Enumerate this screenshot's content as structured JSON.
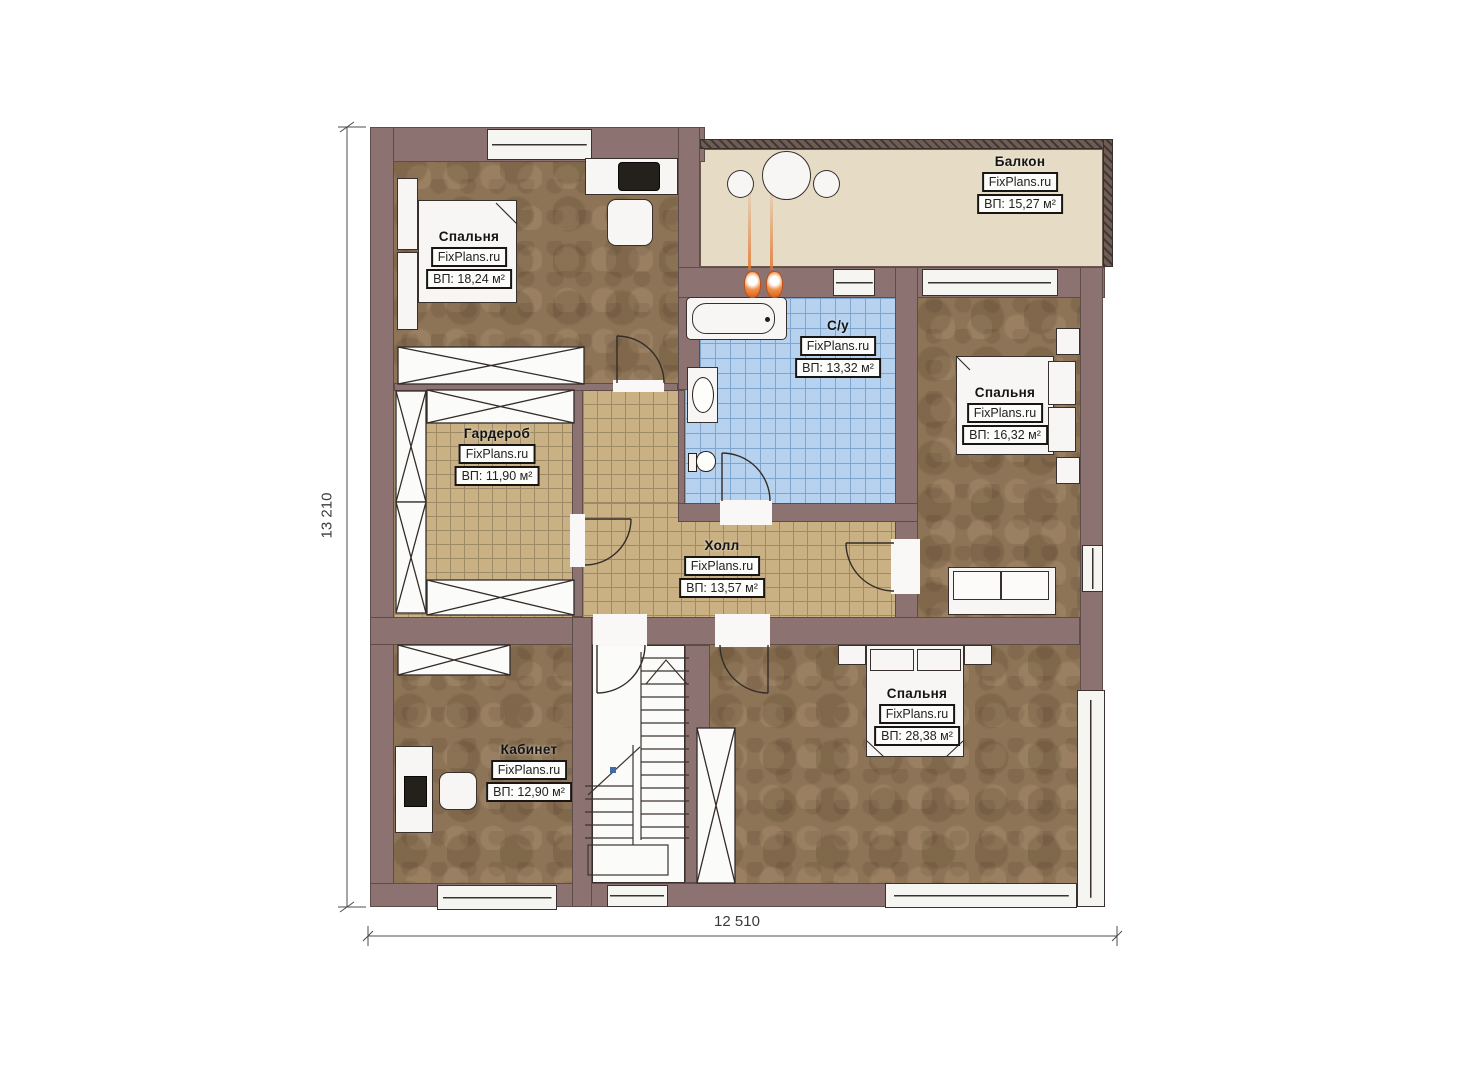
{
  "plan": {
    "type": "floor-plan",
    "watermark": "FixPlans.ru",
    "dimensions": {
      "height_label": "13 210",
      "width_label": "12 510"
    },
    "rooms": [
      {
        "key": "bedroom-top-left",
        "name": "Спальня",
        "brand": "FixPlans.ru",
        "area": "ВП: 18,24 м²"
      },
      {
        "key": "balcony",
        "name": "Балкон",
        "brand": "FixPlans.ru",
        "area": "ВП: 15,27 м²"
      },
      {
        "key": "bathroom",
        "name": "С/у",
        "brand": "FixPlans.ru",
        "area": "ВП: 13,32 м²"
      },
      {
        "key": "bedroom-right",
        "name": "Спальня",
        "brand": "FixPlans.ru",
        "area": "ВП: 16,32 м²"
      },
      {
        "key": "wardrobe",
        "name": "Гардероб",
        "brand": "FixPlans.ru",
        "area": "ВП: 11,90 м²"
      },
      {
        "key": "hall",
        "name": "Холл",
        "brand": "FixPlans.ru",
        "area": "ВП: 13,57 м²"
      },
      {
        "key": "office",
        "name": "Кабинет",
        "brand": "FixPlans.ru",
        "area": "ВП: 12,90 м²"
      },
      {
        "key": "bedroom-bottom",
        "name": "Спальня",
        "brand": "FixPlans.ru",
        "area": "ВП: 28,38 м²"
      }
    ],
    "colors": {
      "wall": "#8c7372",
      "wood_floor": "#8e7456",
      "tile_tan": "#cab184",
      "tile_blue": "#b6d2ee",
      "balcony_floor": "#e6dcc6",
      "linework": "#37302c",
      "flame": "#e2762d"
    }
  }
}
